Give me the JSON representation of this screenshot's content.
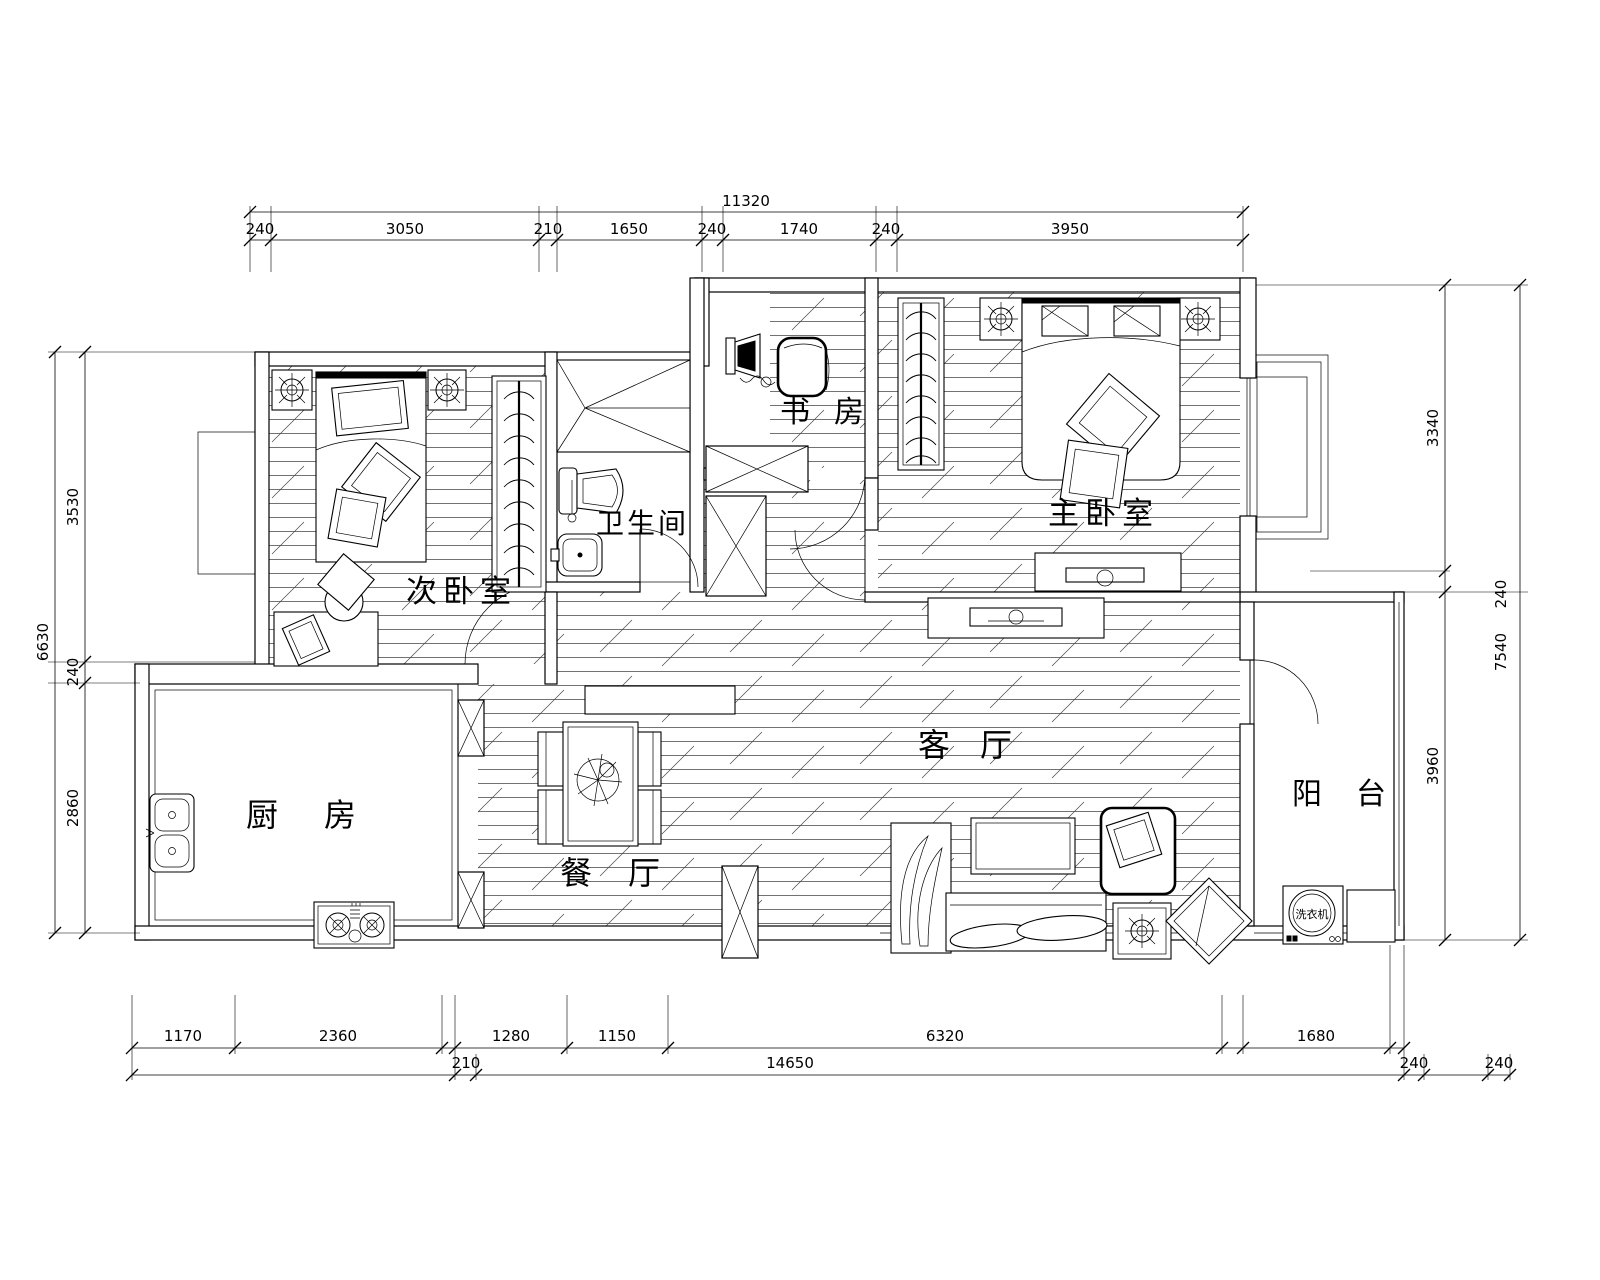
{
  "title": "apartment-floor-plan",
  "rooms": {
    "study": "书房",
    "master_bedroom": "主卧室",
    "second_bedroom": "次卧室",
    "bathroom": "卫生间",
    "kitchen": "厨房",
    "dining": "餐厅",
    "living": "客厅",
    "balcony": "阳台",
    "washer": "洗衣机"
  },
  "dims": {
    "top": {
      "total": "11320",
      "segments": [
        "240",
        "3050",
        "210",
        "1650",
        "240",
        "1740",
        "240",
        "3950"
      ]
    },
    "left": {
      "total": "6630",
      "segments": [
        "3530",
        "240",
        "2860"
      ]
    },
    "right": {
      "total": "7540",
      "segments": [
        "3340",
        "240",
        "3960"
      ]
    },
    "bottom": {
      "row1": [
        "1170",
        "2360",
        "1280",
        "1150",
        "6320",
        "1680"
      ],
      "row2": [
        "210",
        "14650",
        "240",
        "240"
      ]
    }
  },
  "colors": {
    "line": "#000000",
    "background": "#ffffff"
  }
}
